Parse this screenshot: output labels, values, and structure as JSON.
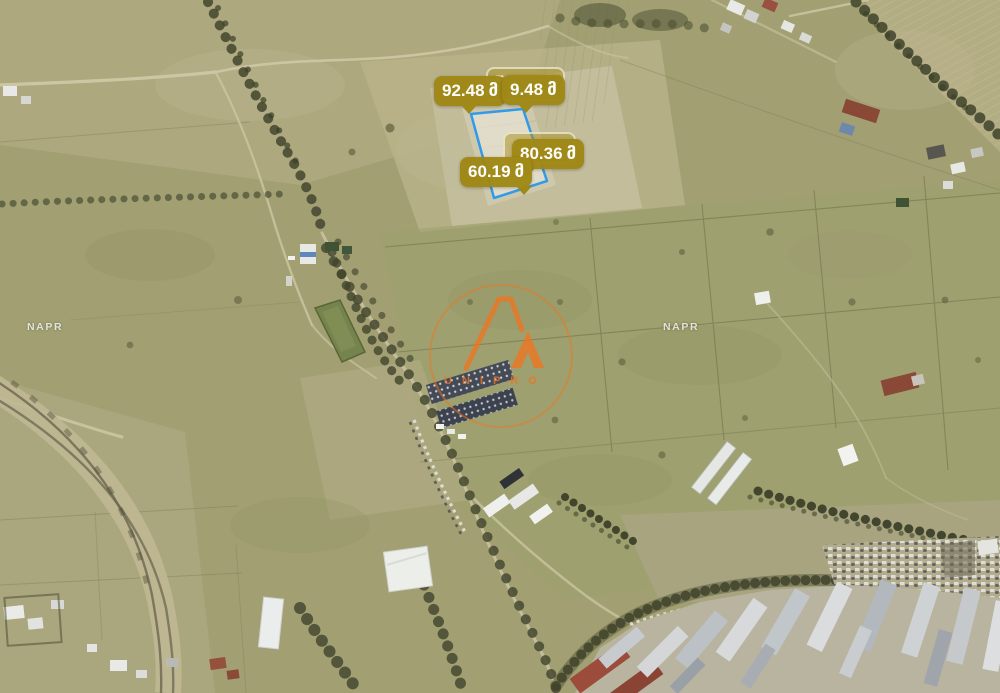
{
  "map": {
    "provider_watermark": "NAPR",
    "logo_watermark_text": "UNIPRO"
  },
  "parcel": {
    "outline_color": "#2f9bea",
    "side_labels": [
      {
        "position": "west",
        "value": "92.48",
        "unit": "მ"
      },
      {
        "position": "north",
        "value": "9.48",
        "unit": "მ"
      },
      {
        "position": "east",
        "value": "80.36",
        "unit": "მ"
      },
      {
        "position": "south",
        "value": "60.19",
        "unit": "მ"
      }
    ],
    "ghost_labels": [
      {
        "fragment": "5"
      },
      {
        "fragment": ""
      }
    ]
  },
  "theme": {
    "measurement_label_bg": "#9f8815",
    "measurement_label_text": "#ffffff",
    "parcel_outline": "#2f9bea",
    "watermark_orange": "#ee7520",
    "terrain_base": "#a2a073"
  }
}
